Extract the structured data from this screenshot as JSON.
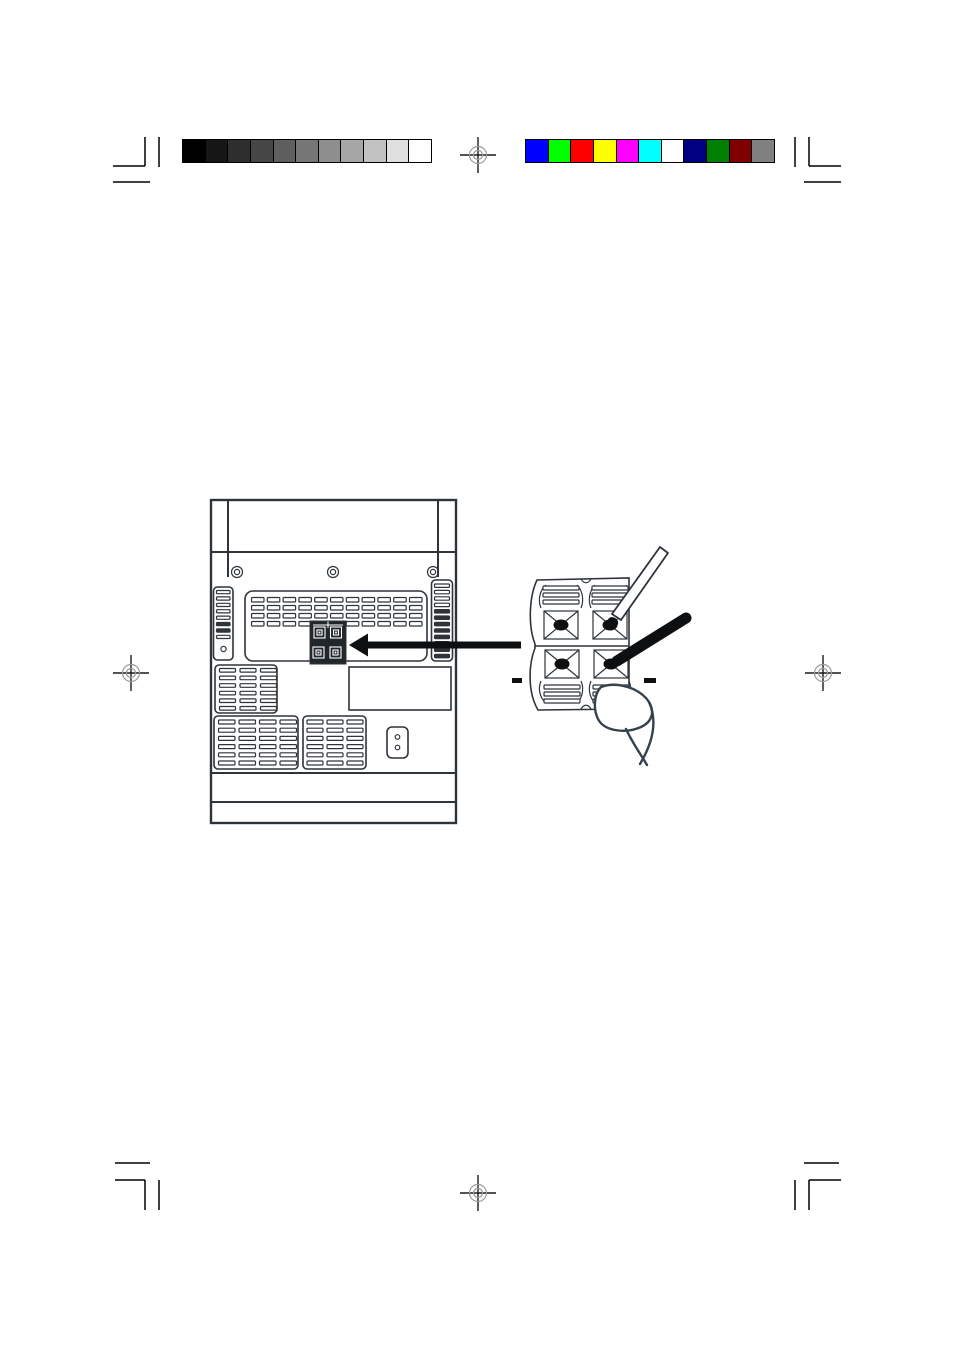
{
  "theme": {
    "page_bg": "#ffffff",
    "line_color": "#2e343a",
    "ink": "#0d0f11",
    "reg_cross": "#1a1a1a",
    "reg_circle": "#9a9a9a",
    "finger_color": "#37414c",
    "terminal_block_fill": "#22272c"
  },
  "calibration": {
    "grayscale_bar": {
      "steps": [
        "#000000",
        "#161616",
        "#2e2e2e",
        "#464646",
        "#5e5e5e",
        "#767676",
        "#8e8e8e",
        "#a6a6a6",
        "#c2c2c2",
        "#e0e0e0",
        "#ffffff"
      ]
    },
    "color_bar": {
      "steps": [
        "#0000ff",
        "#00ff00",
        "#ff0000",
        "#ffff00",
        "#ff00ff",
        "#00ffff",
        "#ffffff",
        "#000080",
        "#008000",
        "#800000",
        "#808080"
      ]
    }
  },
  "registration_marks": {
    "count": 4,
    "positions": [
      "top-center",
      "left-middle",
      "right-middle",
      "bottom-center"
    ]
  },
  "diagram": {
    "back_panel": {
      "screw_count": 3,
      "speaker_terminal_count": 4,
      "vent_blocks": 5,
      "has_ac_inlet": true,
      "has_label_plate": true
    },
    "terminal_closeup": {
      "terminal_count": 4,
      "polarity_marks": [
        "−",
        "−"
      ],
      "wires": [
        "thin-speaker-wire",
        "thick-speaker-wire"
      ],
      "finger_pressing": true
    }
  }
}
